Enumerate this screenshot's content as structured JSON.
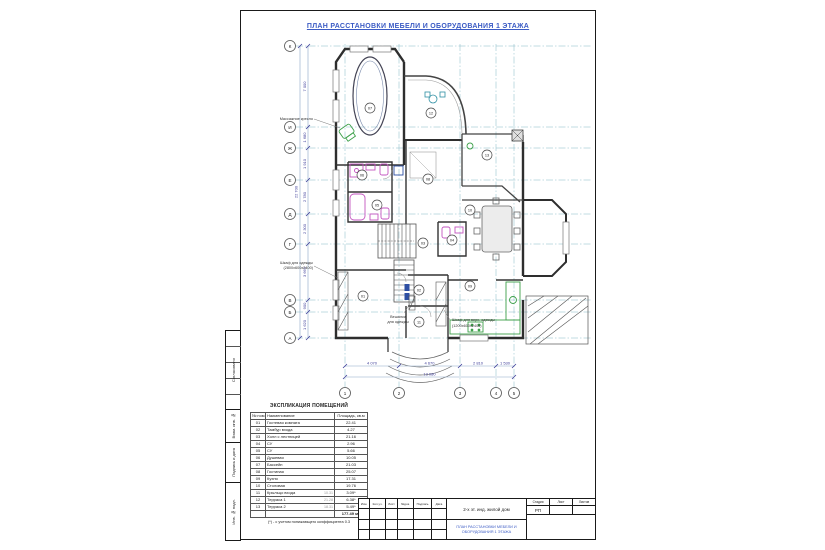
{
  "sheet": {
    "title": "ПЛАН РАССТАНОВКИ МЕБЕЛИ И ОБОРУДОВАНИЯ 1 ЭТАЖА"
  },
  "frame": {
    "side_labels": [
      "Согласовано",
      "Взам. инв. №",
      "Подпись и дата",
      "Инв. № подл."
    ]
  },
  "plan": {
    "axes_left": [
      "К",
      "И",
      "Ж",
      "Е",
      "Д",
      "Г",
      "В",
      "Б",
      "А"
    ],
    "axes_bottom": [
      "1",
      "2",
      "3",
      "4",
      "5"
    ],
    "dims_left": [
      "7 000",
      "1 680",
      "1 910",
      "2 780",
      "2 300",
      "3 660",
      "900",
      "1 620"
    ],
    "dims_left_total": "22 700",
    "dims_bottom": [
      "4 070",
      "4 670",
      "2 810",
      "1 530"
    ],
    "dims_bottom_total": "13 080",
    "room_markers": [
      "01",
      "02",
      "03",
      "04",
      "05",
      "06",
      "07",
      "08",
      "09",
      "10",
      "11",
      "12",
      "13"
    ],
    "annotations": {
      "massage_chair": "Массажное кресло",
      "wardrobe_1": "Шкаф для одежды",
      "wardrobe_2": "(2800х600х2400)",
      "hanger_1": "Вешалка",
      "hanger_2": "для одежды",
      "coat_1": "Шкаф для верх. одежды",
      "coat_2": "(1200х600х2400)"
    }
  },
  "schedule": {
    "title": "ЭКСПЛИКАЦИЯ ПОМЕЩЕНИЙ",
    "headers": [
      "№ пом.",
      "Наименование",
      "Площадь, кв.м"
    ],
    "rows": [
      {
        "num": "01",
        "name": "Гостевая комната",
        "gray": "",
        "area": "22.41"
      },
      {
        "num": "02",
        "name": "Тамбур входа",
        "gray": "",
        "area": "4.27"
      },
      {
        "num": "03",
        "name": "Холл с лестницей",
        "gray": "",
        "area": "21.16"
      },
      {
        "num": "04",
        "name": "СУ",
        "gray": "",
        "area": "2.96"
      },
      {
        "num": "05",
        "name": "СУ",
        "gray": "",
        "area": "5.66"
      },
      {
        "num": "06",
        "name": "Душевая",
        "gray": "",
        "area": "10.05"
      },
      {
        "num": "07",
        "name": "Бассейн",
        "gray": "",
        "area": "21.03"
      },
      {
        "num": "08",
        "name": "Гостиная",
        "gray": "",
        "area": "25.07"
      },
      {
        "num": "09",
        "name": "Кухня",
        "gray": "",
        "area": "17.31"
      },
      {
        "num": "10",
        "name": "Столовая",
        "gray": "",
        "area": "19.76"
      },
      {
        "num": "11",
        "name": "Крыльцо входа",
        "gray": "10.31",
        "area": "3.09*"
      },
      {
        "num": "12",
        "name": "Терраса 1",
        "gray": "21.28",
        "area": "6.38*"
      },
      {
        "num": "13",
        "name": "Терраса 2",
        "gray": "18.31",
        "area": "5.49*"
      }
    ],
    "total": "177.49 м2",
    "footnote": "(*) - с учетом понижающего коэффициента 0.3"
  },
  "titleblock": {
    "rev_headers": [
      "Изм.",
      "Кол.уч.",
      "Лист",
      "№док.",
      "Подпись",
      "Дата"
    ],
    "project": "2-х эт. инд. жилой дом",
    "drawing_title": "ПЛАН РАССТАНОВКИ МЕБЕЛИ И ОБОРУДОВАНИЯ 1 ЭТАЖА",
    "stage_label": "Стадия",
    "sheet_label": "Лист",
    "sheets_label": "Листов",
    "stage_value": "РП"
  },
  "colors": {
    "accent_blue": "#3b5bc4",
    "axis_teal": "#85b8c6",
    "dim_navy": "#3d3d99",
    "fixture_pink": "#c355c0",
    "furniture_green": "#3da04a",
    "wall": "#2e2e2e"
  }
}
